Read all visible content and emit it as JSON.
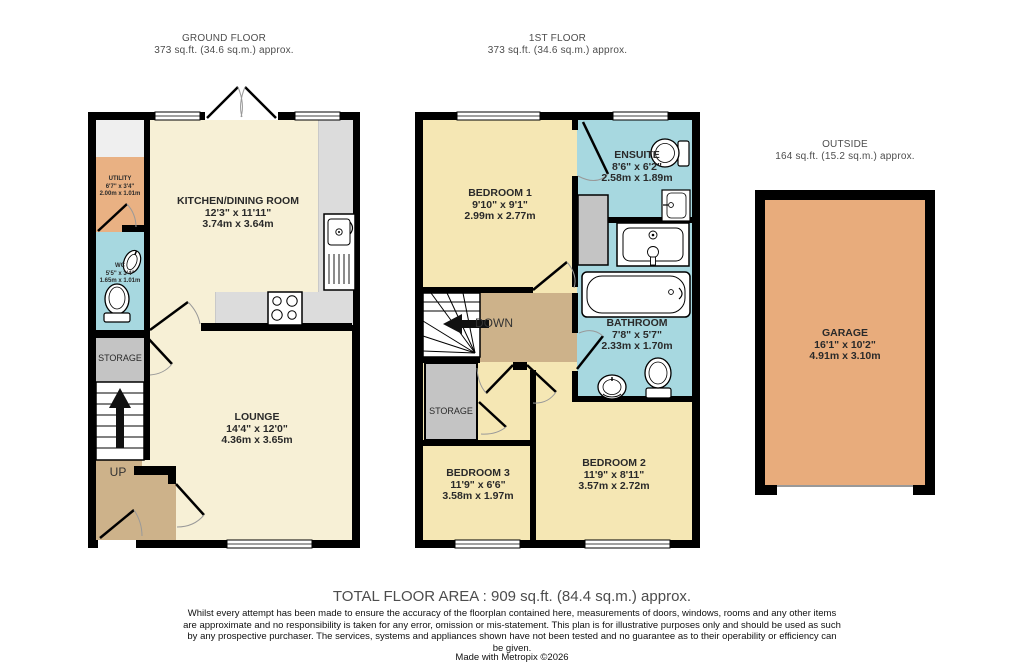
{
  "headers": {
    "ground_floor": {
      "title": "GROUND FLOOR",
      "area": "373 sq.ft. (34.6 sq.m.) approx."
    },
    "first_floor": {
      "title": "1ST FLOOR",
      "area": "373 sq.ft. (34.6 sq.m.) approx."
    },
    "outside": {
      "title": "OUTSIDE",
      "area": "164 sq.ft. (15.2 sq.m.) approx."
    }
  },
  "rooms": {
    "utility": {
      "name": "UTILITY",
      "imperial": "6'7\" x 3'4\"",
      "metric": "2.00m x 1.01m"
    },
    "wc": {
      "name": "WC",
      "imperial": "5'5\" x 3'4\"",
      "metric": "1.65m x 1.01m"
    },
    "storage_gf": {
      "name": "STORAGE"
    },
    "kitchen": {
      "name": "KITCHEN/DINING ROOM",
      "imperial": "12'3\" x 11'11\"",
      "metric": "3.74m x 3.64m"
    },
    "lounge": {
      "name": "LOUNGE",
      "imperial": "14'4\" x 12'0\"",
      "metric": "4.36m x 3.65m"
    },
    "bedroom1": {
      "name": "BEDROOM 1",
      "imperial": "9'10\" x 9'1\"",
      "metric": "2.99m x 2.77m"
    },
    "ensuite": {
      "name": "ENSUITE",
      "imperial": "8'6\" x 6'2\"",
      "metric": "2.58m x 1.89m"
    },
    "bathroom": {
      "name": "BATHROOM",
      "imperial": "7'8\" x 5'7\"",
      "metric": "2.33m x 1.70m"
    },
    "storage_ff": {
      "name": "STORAGE"
    },
    "bedroom2": {
      "name": "BEDROOM 2",
      "imperial": "11'9\" x 8'11\"",
      "metric": "3.57m x 2.72m"
    },
    "bedroom3": {
      "name": "BEDROOM 3",
      "imperial": "11'9\" x 6'6\"",
      "metric": "3.58m x 1.97m"
    },
    "garage": {
      "name": "GARAGE",
      "imperial": "16'1\" x 10'2\"",
      "metric": "4.91m x 3.10m"
    }
  },
  "labels": {
    "up": "UP",
    "down": "DOWN"
  },
  "footer": {
    "total": "TOTAL FLOOR AREA : 909 sq.ft. (84.4 sq.m.) approx.",
    "disclaimer": "Whilst every attempt has been made to ensure the accuracy of the floorplan contained here, measurements of doors, windows, rooms and any other items are approximate and no responsibility is taken for any error, omission or mis-statement. This plan is for illustrative purposes only and should be used as such by any prospective purchaser. The services, systems and appliances shown have not been tested and no guarantee as to their operability or efficiency can be given.",
    "credit": "Made with Metropix ©2026"
  },
  "colors": {
    "wall": "#000000",
    "floor_cream": "#F7F0D6",
    "floor_bedroom": "#F5E7B4",
    "wet_room_blue": "#A7D8E0",
    "utility_orange": "#E9B183",
    "garage_orange": "#E8AC7C",
    "hall_tan": "#CDB28A",
    "storage_gray": "#C4C4C4",
    "counter_gray": "#DCDCDC"
  }
}
